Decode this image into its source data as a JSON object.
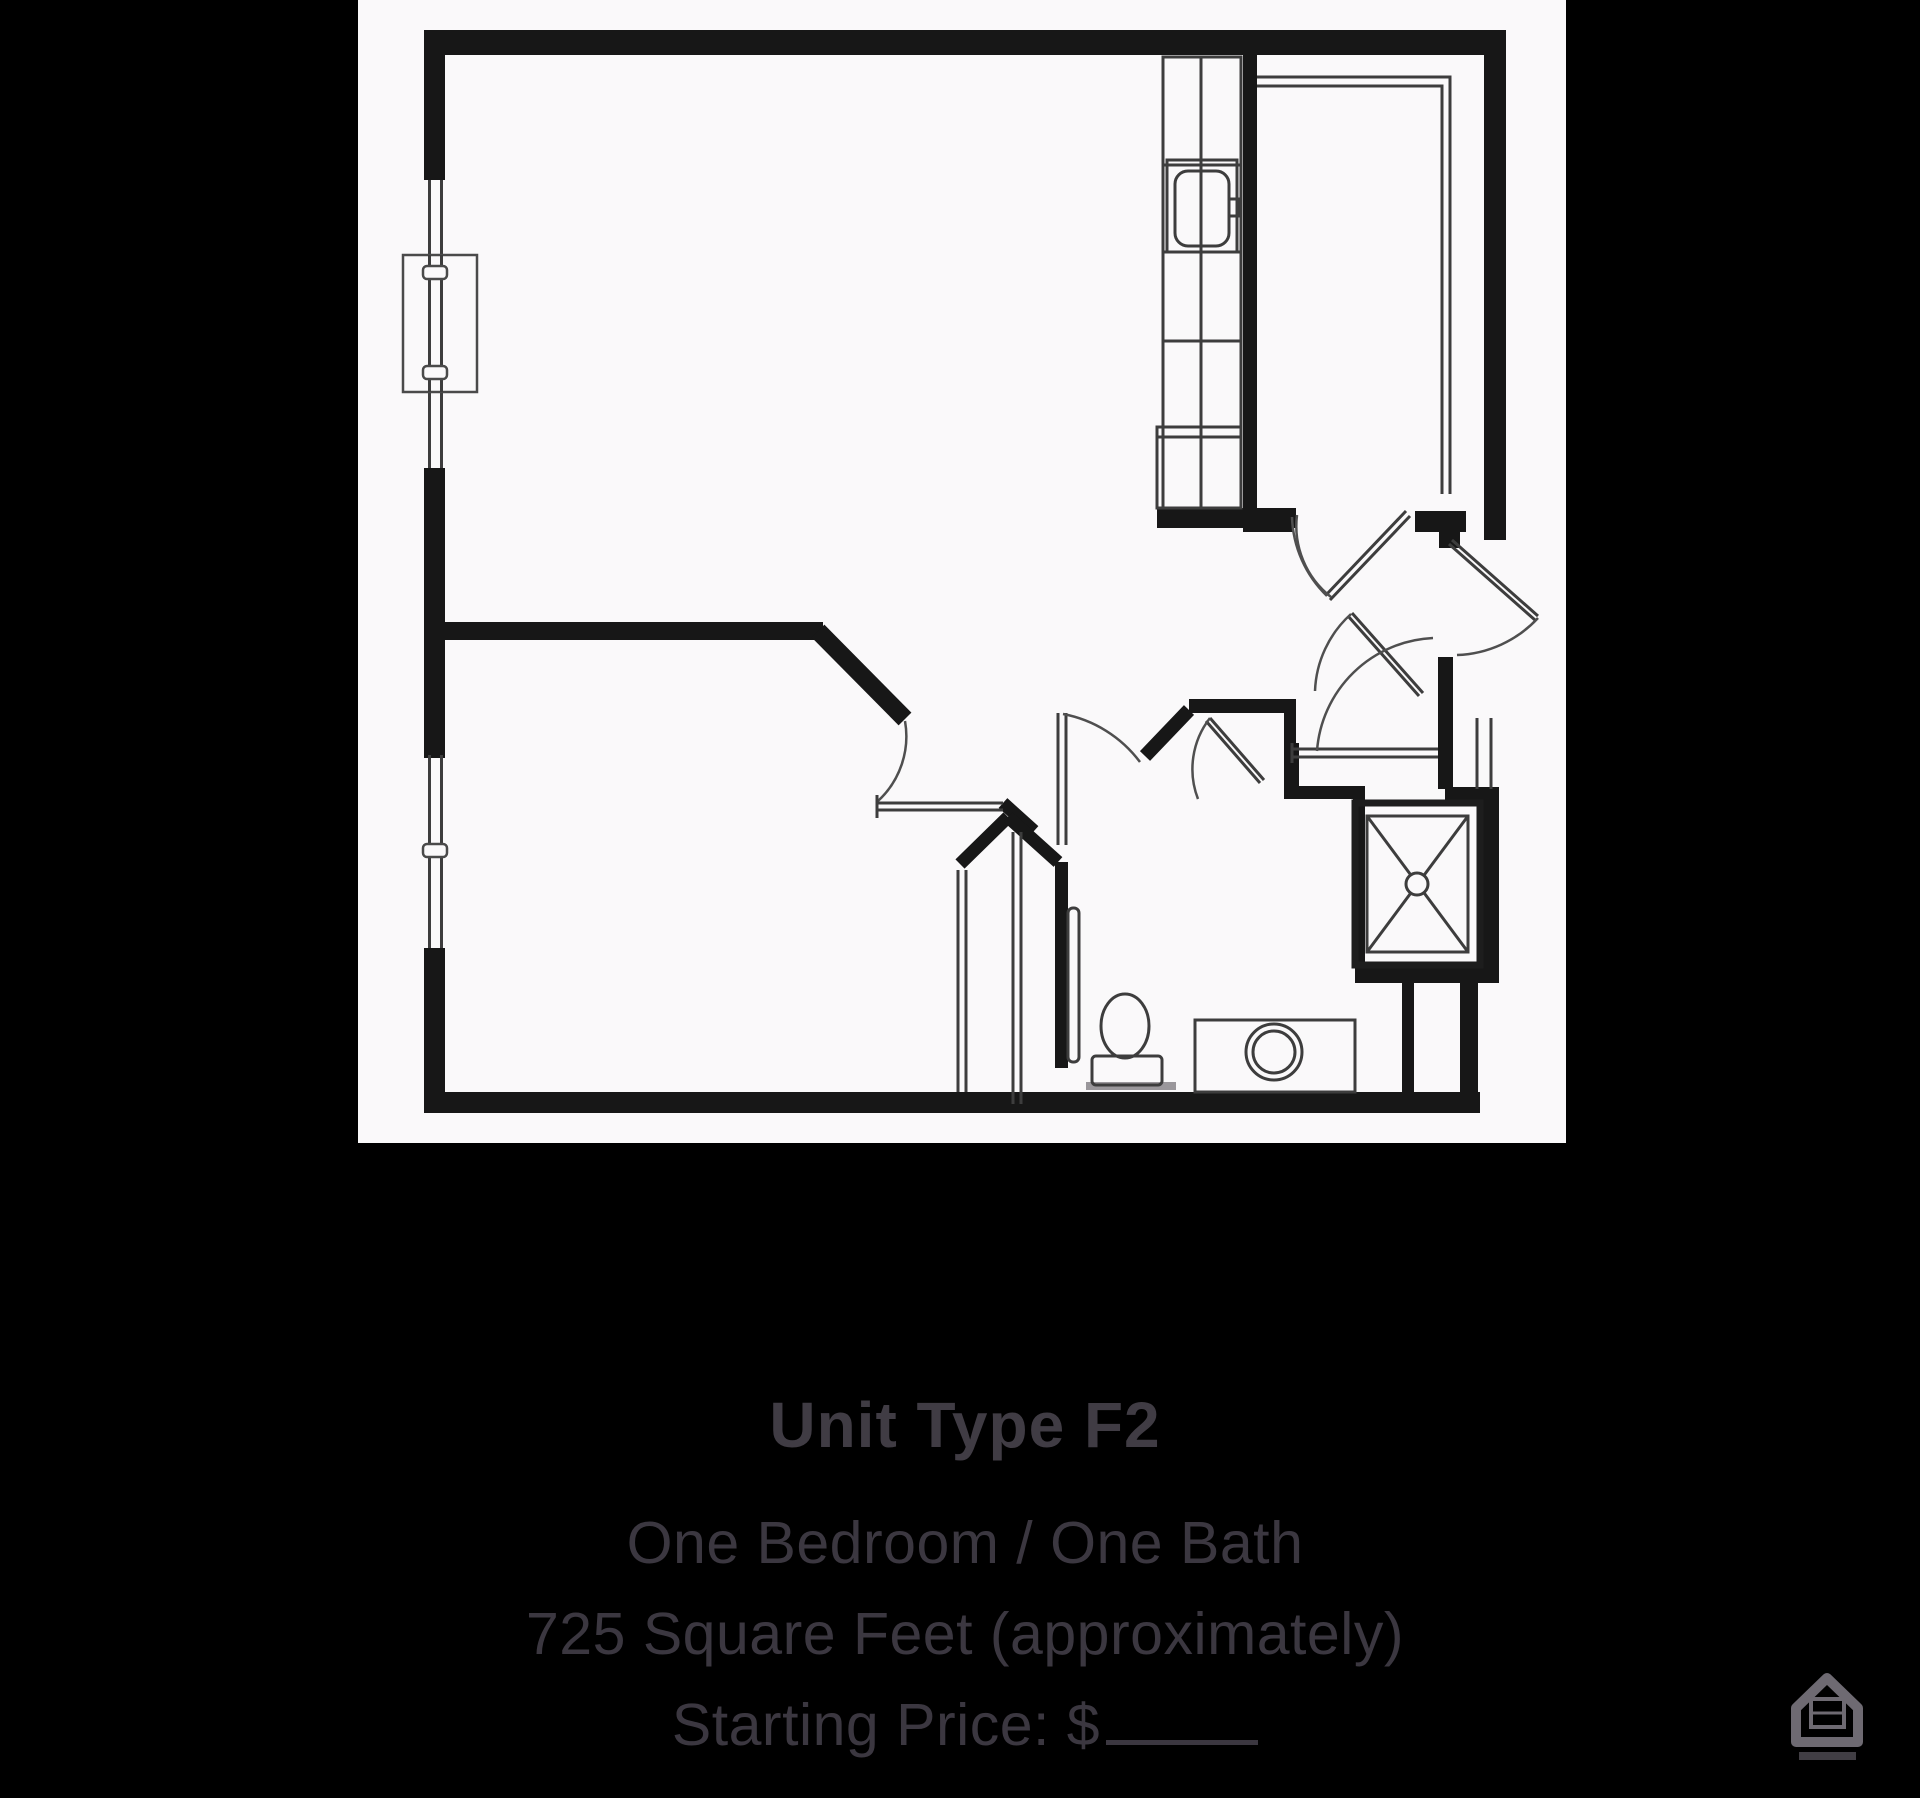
{
  "caption": {
    "title": "Unit Type F2",
    "lines": [
      "One Bedroom / One Bath",
      "725 Square Feet (approximately)",
      "Starting Price: $"
    ]
  },
  "plan": {
    "type": "floor-plan",
    "unit": "one-bedroom apartment",
    "fixtures": [
      "kitchen-counter",
      "kitchen-sink",
      "pantry-room",
      "entry-door",
      "interior-doors",
      "coat-closet",
      "bathroom",
      "toilet",
      "vanity-sink",
      "shower",
      "bedroom",
      "bedroom-closet",
      "left-wall-windows"
    ]
  },
  "colors": {
    "background": "#000000",
    "plan_background": "#faf9fa",
    "plan_line": "#171717",
    "caption_text": "#3b3740",
    "logo_gray": "#6e6a72"
  }
}
